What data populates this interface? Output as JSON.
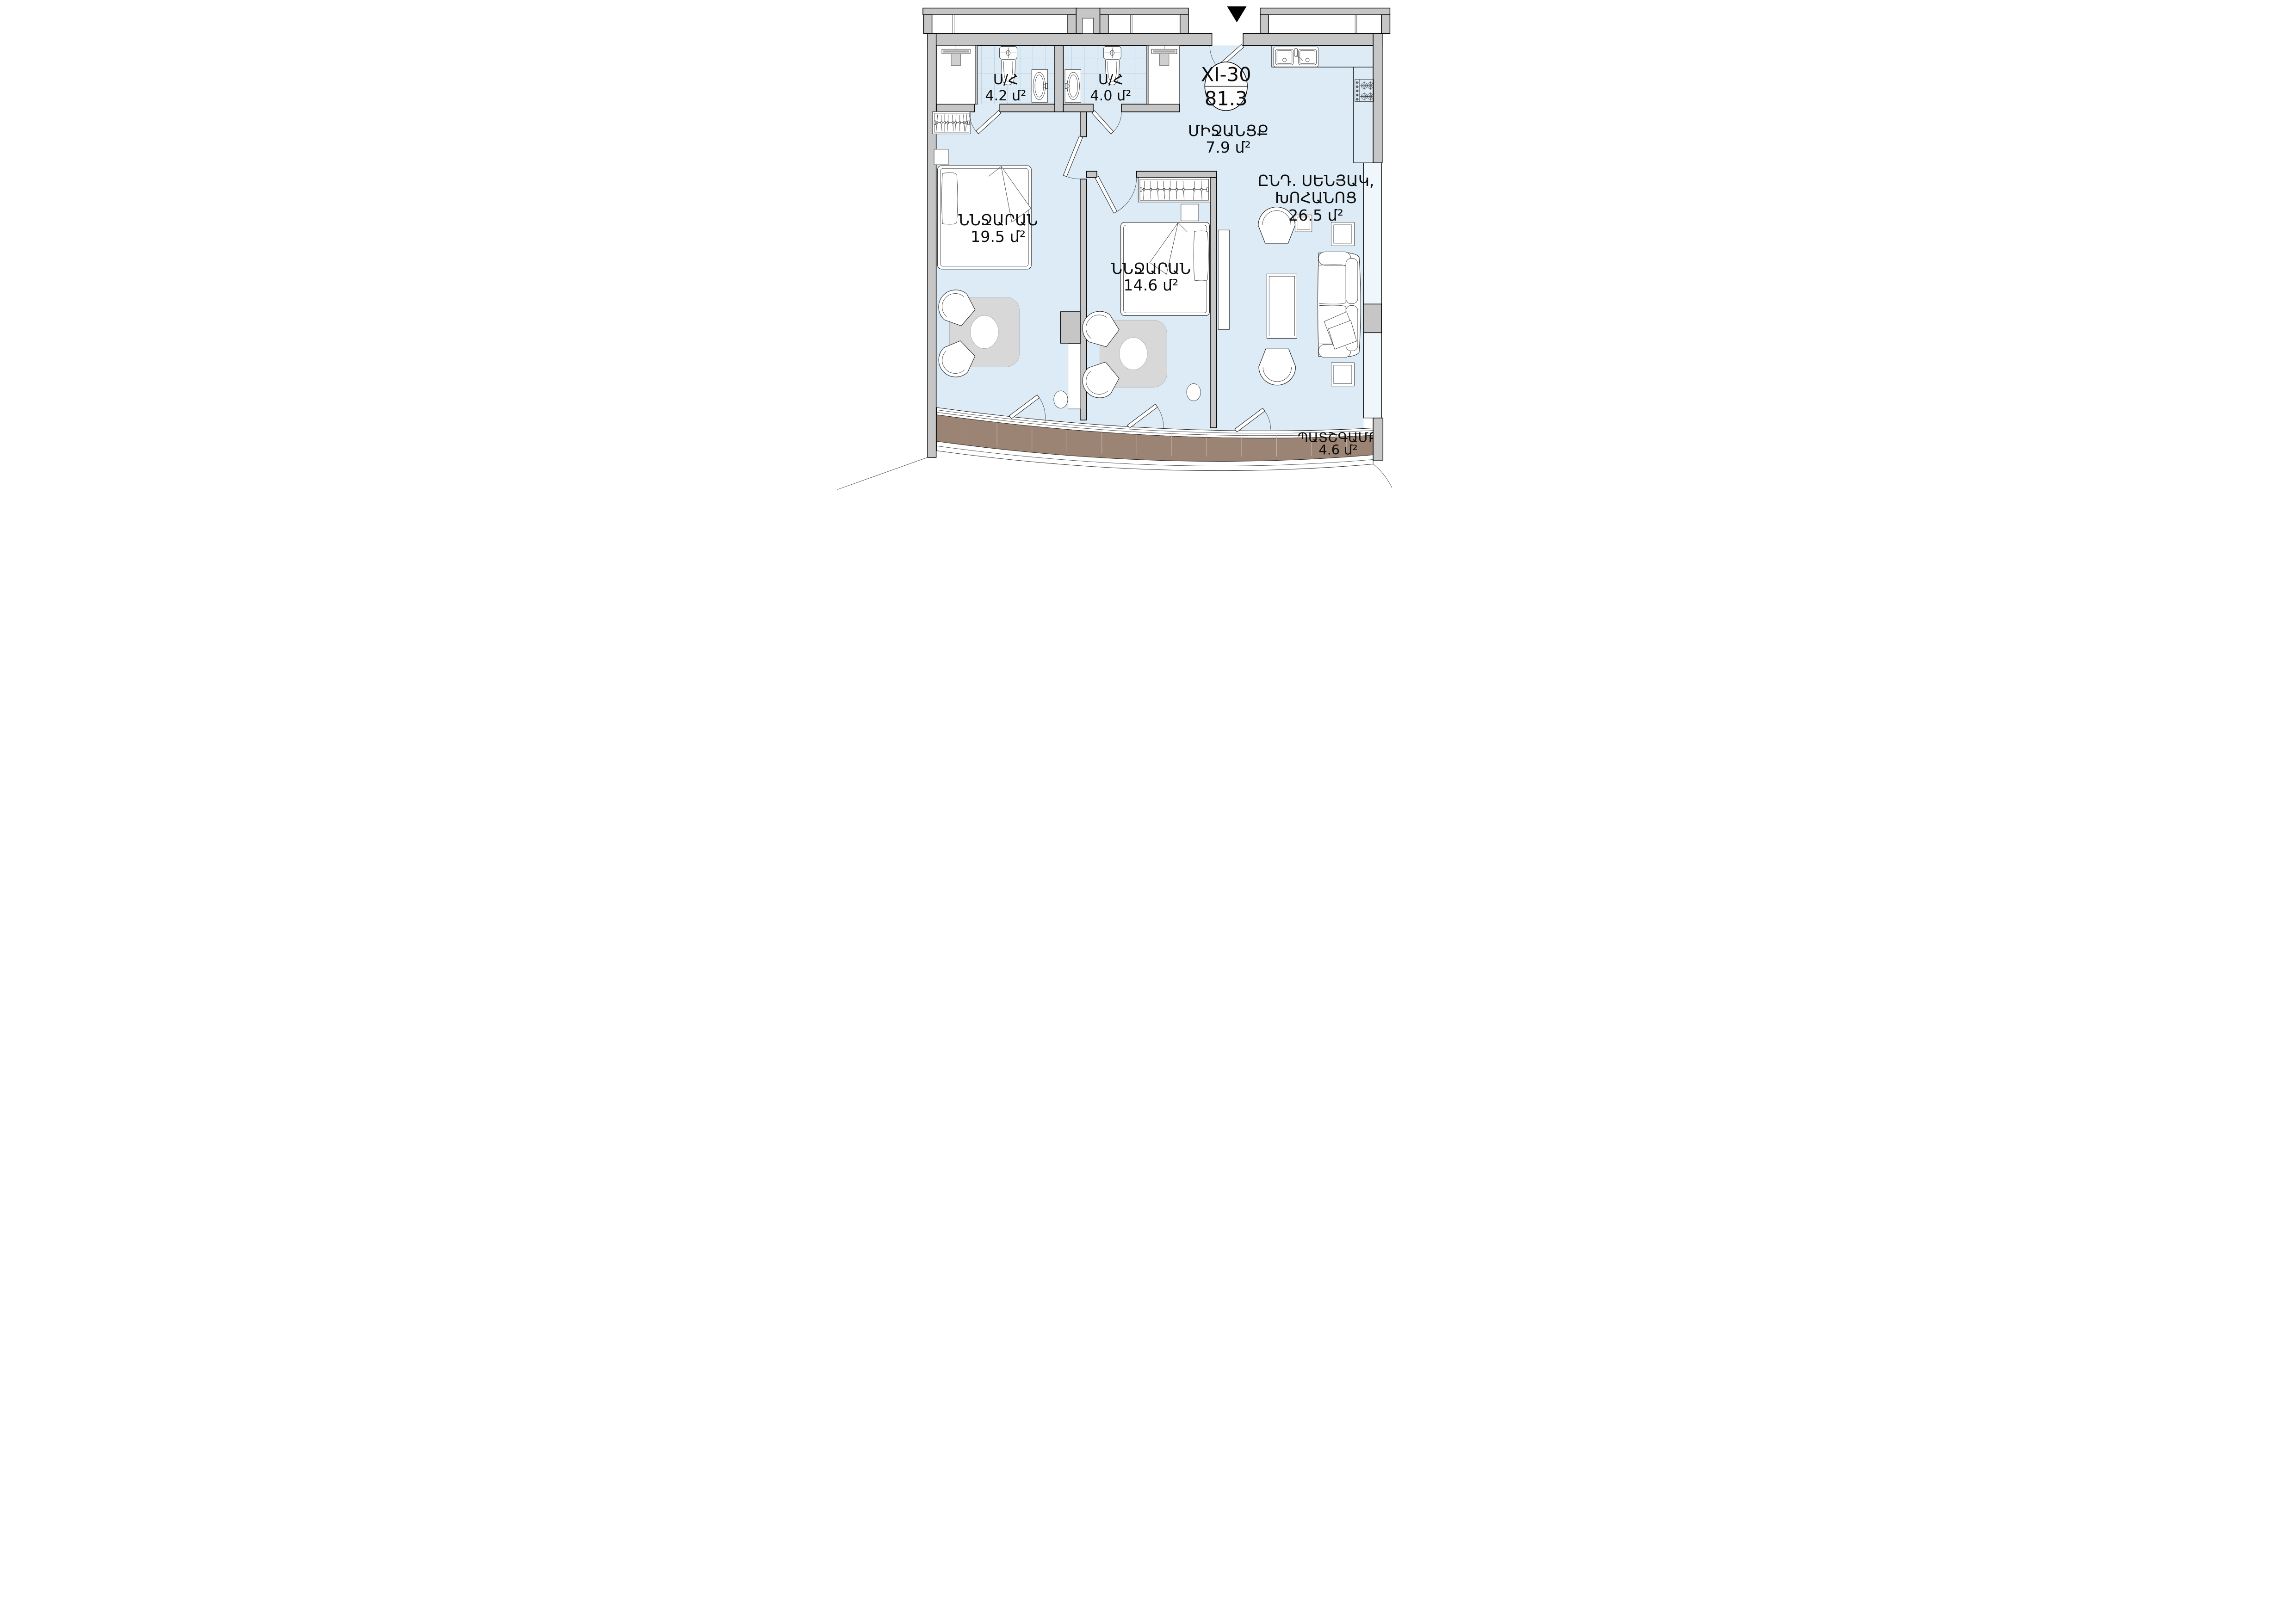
{
  "unit": {
    "number": "XI-30",
    "total_area": "81.3"
  },
  "rooms": {
    "bathroom_1": {
      "label": "Ս/Հ",
      "area": "4.2 մ²"
    },
    "bathroom_2": {
      "label": "Ս/Հ",
      "area": "4.0 մ²"
    },
    "hallway": {
      "label": "ՄԻՋԱՆՑՔ",
      "area": "7.9 մ²"
    },
    "living_kitchen": {
      "label_line1": "ԸՆԴ. ՍԵՆՅԱԿ,",
      "label_line2": "ԽՈՀԱՆՈՑ",
      "area": "26.5 մ²"
    },
    "bedroom_1": {
      "label": "ՆՆՋԱՐԱՆ",
      "area": "19.5 մ²"
    },
    "bedroom_2": {
      "label": "ՆՆՋԱՐԱՆ",
      "area": "14.6 մ²"
    },
    "balcony": {
      "label": "ՊԱՏՇԳԱՄԲ",
      "area": "4.6 մ²"
    }
  },
  "icons": {
    "entrance_arrow": "black triangle pointing down at apartment entry"
  },
  "colors": {
    "floor": "#dcebf5",
    "wall": "#c6c6c6",
    "deck": "#9b8474",
    "plank": "#cdc2b8",
    "table": "#d8d8d8",
    "tile_line": "#8fa8ba"
  }
}
